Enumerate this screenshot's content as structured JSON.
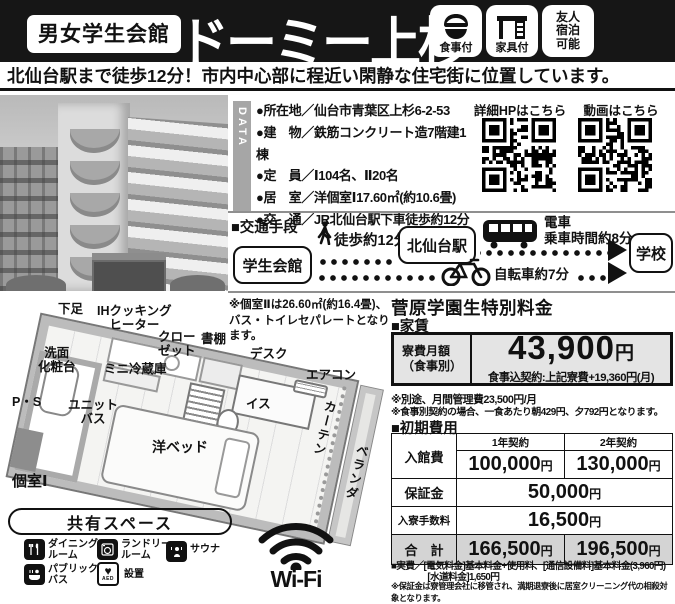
{
  "header": {
    "badge": "男女学生会館",
    "title": "ドーミー上杉",
    "features": [
      {
        "icon": "rice-bowl-icon",
        "label": "食事付"
      },
      {
        "icon": "desk-icon",
        "label": "家具付"
      },
      {
        "icon": "none",
        "label": "友人\n宿泊\n可能"
      }
    ]
  },
  "subtitle": "北仙台駅まで徒歩12分！市内中心部に程近い閑静な住宅街に位置しています。",
  "data_section": {
    "label": "DATA",
    "items": [
      "●所在地／仙台市青葉区上杉6-2-53",
      "●建　物／鉄筋コンクリート造7階建1棟",
      "●定　員／Ⅰ104名、Ⅱ20名",
      "●居　室／洋個室Ⅰ17.60㎡(約10.6畳)",
      "●交　通／JR北仙台駅下車徒歩約12分"
    ]
  },
  "qr": {
    "hp_label": "詳細HPはこちら",
    "video_label": "動画はこちら"
  },
  "transport": {
    "title": "■交通手段",
    "from": "学生会館",
    "station": "北仙台駅",
    "to": "学校",
    "walk": "徒歩約12分",
    "train": "電車\n乗車時間約8分",
    "bicycle": "自転車約7分"
  },
  "floorplan": {
    "note": "※個室Ⅱは26.60㎡(約16.4畳)、\nバス・トイレセパレートとなります。",
    "room_label": "個室Ⅰ",
    "labels": {
      "geta": "下足",
      "ih": "IHクッキング\nヒーター",
      "closet": "クロー\nゼット",
      "shelf": "書棚",
      "desk": "デスク",
      "washstand": "洗面\n化粧台",
      "fridge": "ミニ冷蔵庫",
      "aircon": "エアコン",
      "ps": "P・S",
      "chair": "イス",
      "unit_bath": "ユニット\nバス",
      "curtain": "カーテン",
      "bed": "洋ベッド",
      "veranda": "ベランダ"
    }
  },
  "shared": {
    "title": "共有スペース",
    "dining": "ダイニング\nルーム",
    "laundry": "ランドリー\nルーム",
    "sauna": "サウナ",
    "public_bath": "パブリック\nバス",
    "aed_label": "設置",
    "aed_icon_text": "AED",
    "aed_heart": "♥"
  },
  "wifi": "Wi-Fi",
  "pricing": {
    "title": "菅原学園生特別料金",
    "rent": {
      "heading": "■家賃",
      "row_label": "寮費月額\n（食事別）",
      "amount": "43,900",
      "unit": "円",
      "meal_note": "食事込契約:上記寮費+19,360円(月)",
      "note1": "※別途、月間管理費23,500円/月",
      "note2": "※食事別契約の場合、一食あたり朝429円、夕792円となります。"
    },
    "initial": {
      "heading": "■初期費用",
      "col1": "1年契約",
      "col2": "2年契約",
      "row_admission": "入館費",
      "admission_1yr": "100,000",
      "admission_2yr": "130,000",
      "row_deposit": "保証金",
      "deposit": "50,000",
      "row_fee": "入寮手数料",
      "fee": "16,500",
      "row_total": "合　計",
      "total_1yr": "166,500",
      "total_2yr": "196,500",
      "yen": "円"
    },
    "footer_note1": "■実費／[電気料金]基本料金+使用料、[通信設備料]基本料金(3,960円)",
    "footer_note2": "　　　　[水道料金]1,650円",
    "footer_note3": "※保証金は寮管理会社に移管され、満期退寮後に居室クリーニング代の相殺対象となります。"
  },
  "colors": {
    "header_bg": "#161616",
    "table_gray": "#e4e4e4",
    "total_gray": "#d4d4d4"
  }
}
